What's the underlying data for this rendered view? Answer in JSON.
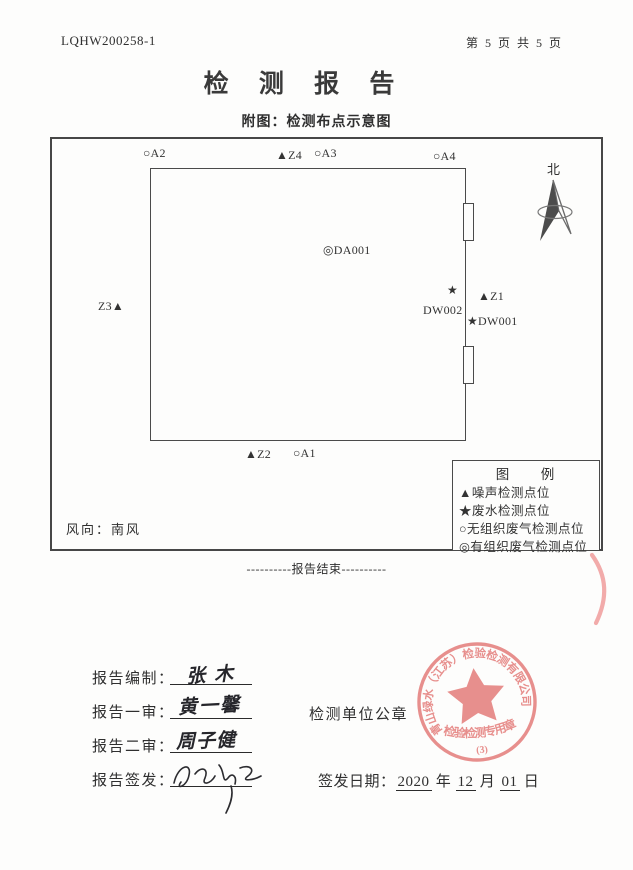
{
  "header": {
    "report_no": "LQHW200258-1",
    "page_info": "第 5 页 共 5 页",
    "title": "检 测 报 告",
    "subtitle": "附图：检测布点示意图"
  },
  "diagram": {
    "north_label": "北",
    "wind_label": "风向：南风",
    "points": [
      {
        "text": "○A2"
      },
      {
        "text": "▲Z4"
      },
      {
        "text": "○A3"
      },
      {
        "text": "○A4"
      },
      {
        "text": "◎DA001"
      },
      {
        "marker": "★",
        "label": "DW002"
      },
      {
        "text": "▲Z1"
      },
      {
        "text": "★DW001"
      },
      {
        "text": "Z3▲"
      },
      {
        "text": "▲Z2"
      },
      {
        "text": "○A1"
      }
    ],
    "legend": {
      "title": "图　例",
      "items": [
        "▲噪声检测点位",
        "★废水检测点位",
        "○无组织废气检测点位",
        "◎有组织废气检测点位"
      ]
    }
  },
  "footer": {
    "end_line": "----------报告结束----------"
  },
  "signoff": {
    "rows": [
      {
        "label": "报告编制：",
        "signature": "张木"
      },
      {
        "label": "报告一审：",
        "signature": "黄一馨"
      },
      {
        "label": "报告二审：",
        "signature": "周子健"
      },
      {
        "label": "报告签发：",
        "signature": ""
      }
    ],
    "seal_label": "检测单位公章",
    "date": {
      "label": "签发日期：",
      "year": "2020",
      "year_unit": "年",
      "month": "12",
      "month_unit": "月",
      "day": "01",
      "day_unit": "日"
    }
  },
  "stamp": {
    "ring_text": "青山绿水（江苏）检验检测有限公司",
    "caption": "检验检测专用章",
    "number": "(3)",
    "color": "#e5807e"
  }
}
